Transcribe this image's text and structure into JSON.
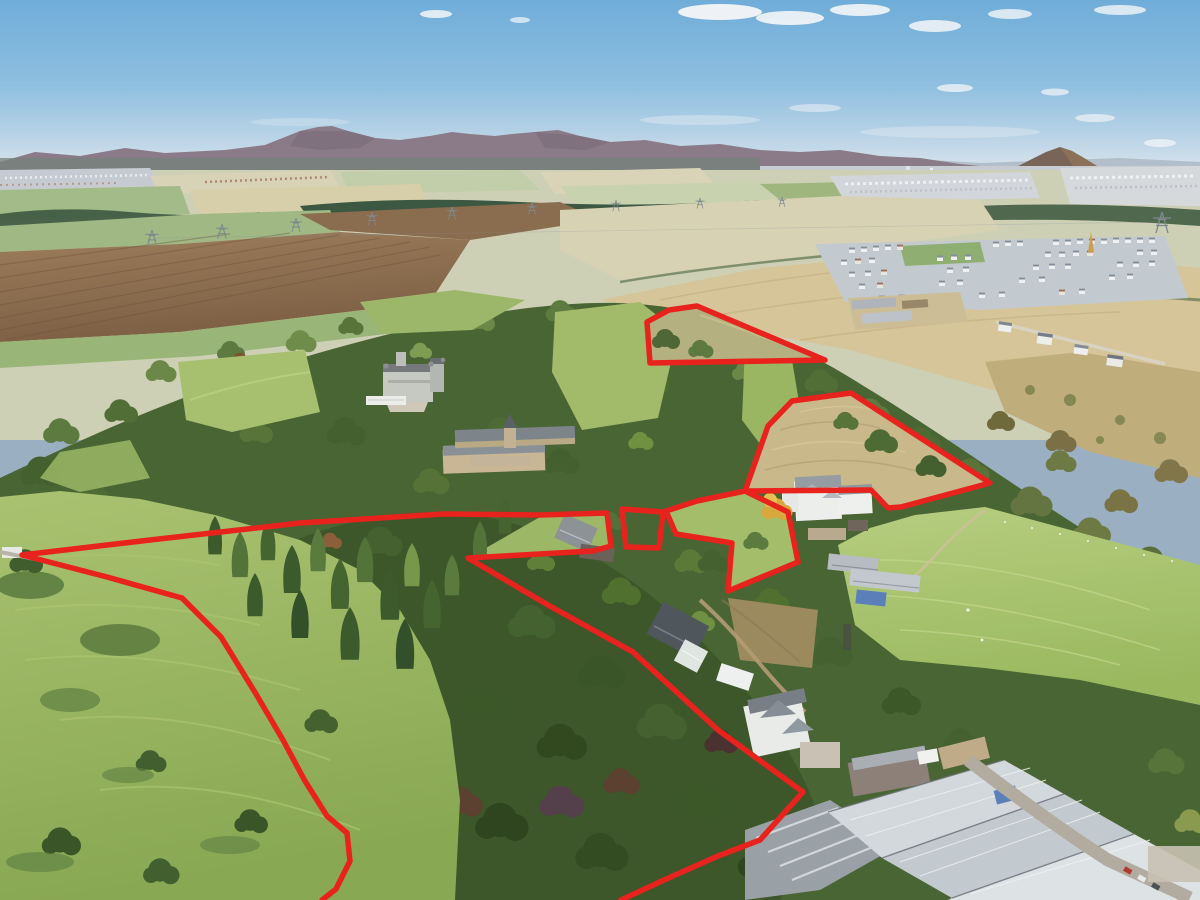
{
  "image": {
    "kind": "aerial-drone-photograph",
    "visible_text": ""
  },
  "annotations": {
    "color": "#e8231d",
    "stroke_width": 5.5,
    "boundaries": [
      {
        "name": "north-wedge-parcel",
        "closed": true,
        "points": "647,322 669,310 697,306 825,360 650,363"
      },
      {
        "name": "east-field-parcel",
        "closed": true,
        "points": "792,401 851,393 990,483 901,507 888,508 871,490 745,491 768,426"
      },
      {
        "name": "central-small-parcel",
        "closed": true,
        "points": "622,509 663,512 659,548 626,547"
      },
      {
        "name": "central-paddock-parcel",
        "closed": true,
        "points": "666,511 676,534 732,543 728,591 798,562 788,512 745,491 697,501"
      },
      {
        "name": "west-woodland-boundary",
        "closed": false,
        "points": "322,900 336,889 350,861 347,833 327,816 305,781 283,740 256,694 221,637 182,598 107,577 22,555 150,540 300,523 443,514 540,515 607,513 611,546 593,551 468,558 548,605 633,652 718,730 803,792 760,840 718,856 664,880 621,900"
      }
    ]
  },
  "palette": {
    "sky_top": "#6fadd9",
    "sky_horizon": "#e7ebee",
    "distant_hills": "#8b7a87",
    "woodland": "#4a6534",
    "pasture": "#a3bd6d",
    "stubble_field": "#d6c598",
    "ploughed_field": "#8a6c4e",
    "boundary_red": "#e8231d"
  }
}
